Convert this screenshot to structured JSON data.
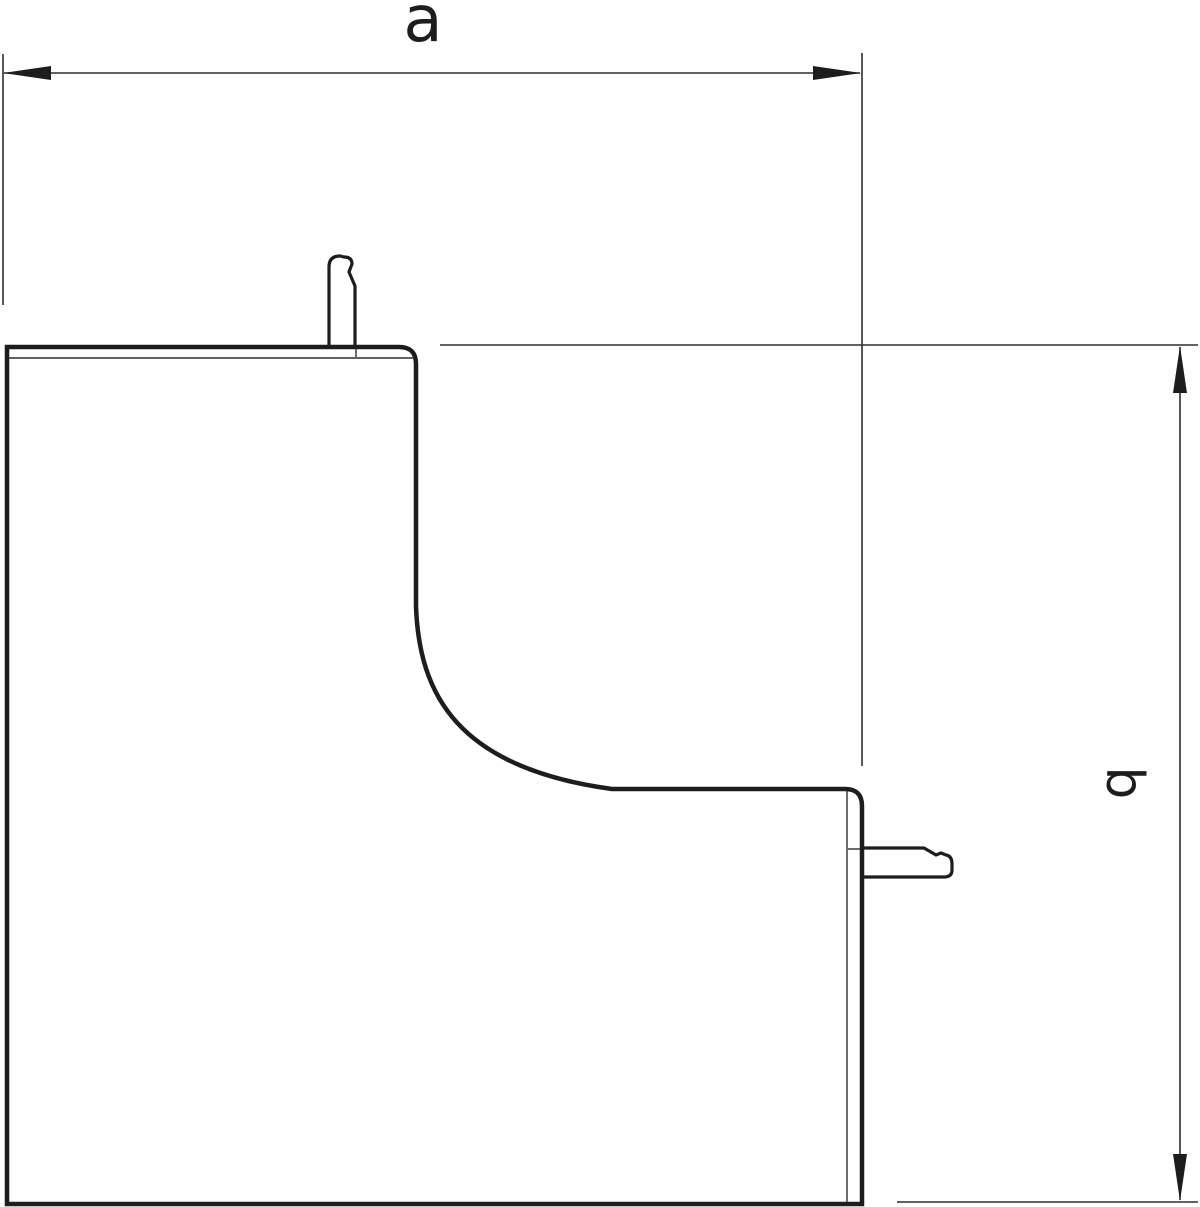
{
  "drawing": {
    "background_color": "#ffffff",
    "line_color": "#1d1d1d",
    "thin_line_color": "#2e2e2e",
    "dimension_labels": {
      "a": "a",
      "b": "b"
    }
  }
}
